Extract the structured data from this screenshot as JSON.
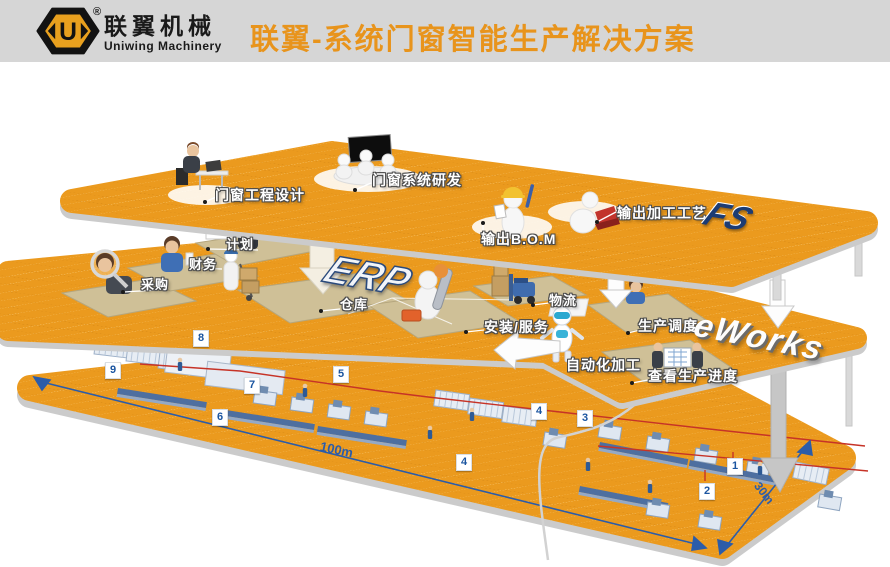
{
  "header": {
    "brand_cn": "联翼机械",
    "brand_en": "Uniwing Machinery",
    "registered": "®",
    "logo_letter": "U",
    "title": "联翼-系统门窗智能生产解决方案"
  },
  "tiers": {
    "design_layer": {
      "big_label": "FS",
      "stations": {
        "engineering": "门窗工程设计",
        "rnd": "门窗系统研发",
        "bom": "输出B.O.M",
        "process": "输出加工工艺"
      }
    },
    "erp_layer": {
      "big_label": "ERP",
      "mes_label": "eWorks",
      "stations": {
        "plan": "计划",
        "finance": "财务",
        "purchase": "采购",
        "warehouse": "仓库",
        "install": "安装/服务",
        "logistics": "物流",
        "dispatch": "生产调度",
        "automation": "自动化加工",
        "progress": "查看生产进度"
      }
    },
    "factory_layer": {
      "markers": [
        "1",
        "2",
        "3",
        "4",
        "4",
        "5",
        "6",
        "7",
        "8",
        "9"
      ],
      "length_label": "100m",
      "width_label": "30m"
    }
  },
  "colors": {
    "platform_orange": "#EB9A1E",
    "title_orange": "#E8941C",
    "marker_blue": "#1B55A0",
    "dimension_blue": "#2B5CA9",
    "route_red": "#C63327"
  }
}
